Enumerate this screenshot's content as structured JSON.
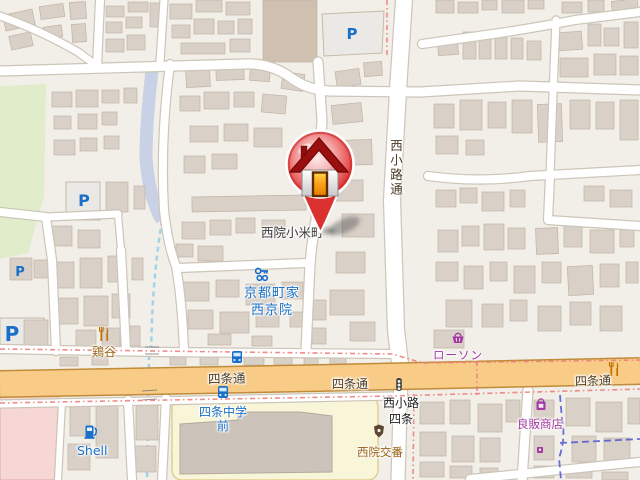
{
  "map": {
    "place": {
      "neighborhood_label": "西院小米町"
    },
    "streets": {
      "shijo": "四条通",
      "nishikoji": "西小路通",
      "intersection_line1": "西小路",
      "intersection_line2": "四条"
    },
    "pois": {
      "guesthouse_line1": "京都町家",
      "guesthouse_line2": "西京院",
      "restaurant": "鶏谷",
      "convenience_store": "ローソン",
      "shop": "良販商店",
      "fuel_station": "Shell",
      "police_box": "西院交番",
      "bus_stop_line1": "四条中学",
      "bus_stop_line2": "前",
      "parking_letter": "P"
    },
    "colors": {
      "land": "#f2efe9",
      "building": "#d9d0c8",
      "building_dark": "#cfc0b0",
      "building_outline": "#c2b3a4",
      "road_primary": "#f8cb87",
      "road_primary_casing": "#c08c39",
      "road_minor": "#ffffff",
      "road_casing": "#ccc5b8",
      "school": "#f8f5d8",
      "park": "#e0ecca",
      "hospital": "#f6d7d5",
      "parking_lot": "#ebe9e6",
      "water": "#c9d1e6",
      "stream": "#a0d2e8",
      "boundary_pink": "#ee7e7c",
      "boundary_blue": "#4d58d6",
      "transport_blue": "#1a70c8",
      "shop_purple": "#a239a2",
      "amenity_brown": "#9a5f0c",
      "amenity_icon": "#bf7000",
      "marker_red": "#db3030",
      "label_dark": "#3a3a3a",
      "road_label": "#4a3a22"
    }
  }
}
